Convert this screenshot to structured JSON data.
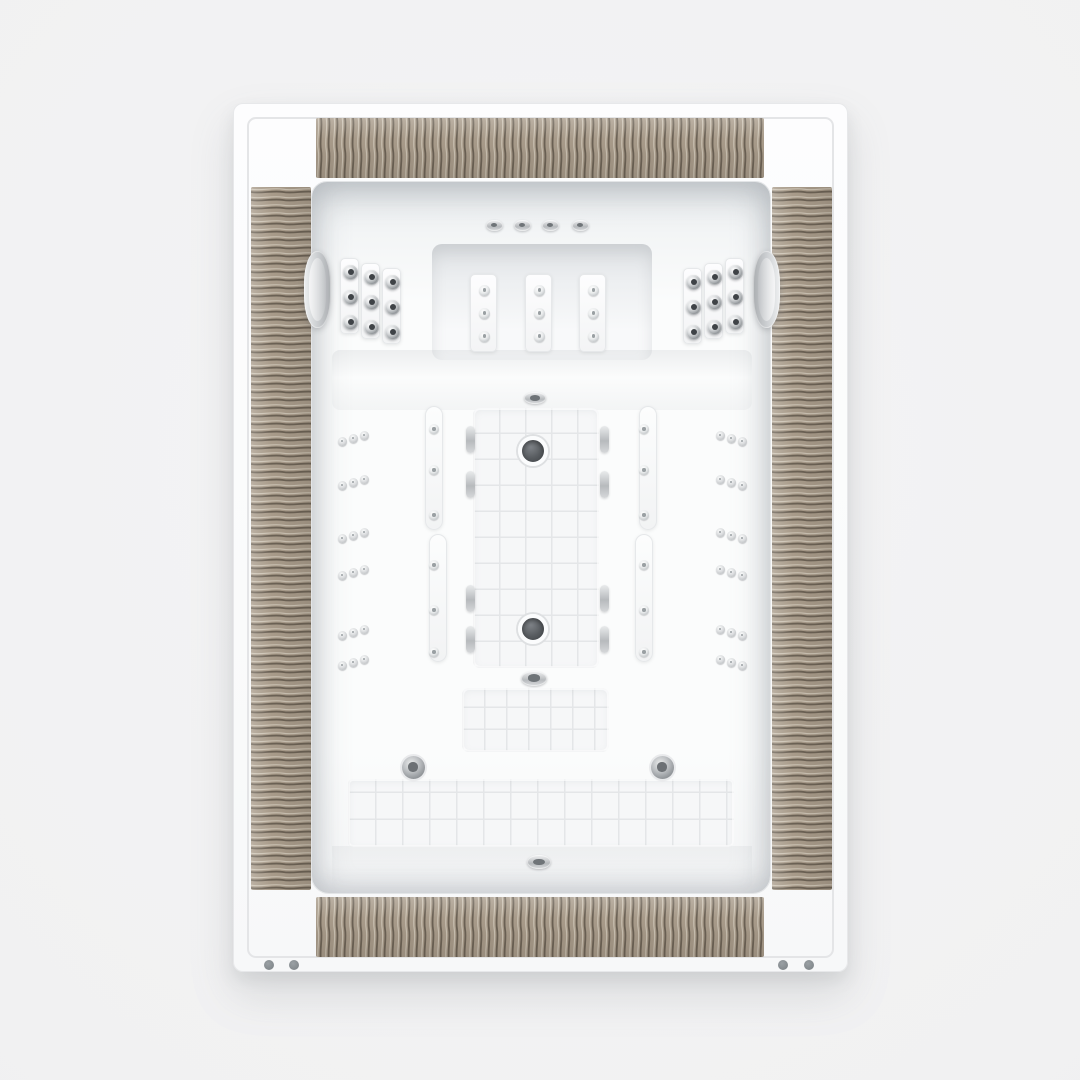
{
  "scene": {
    "title": "Whirlpool bathtub - top view",
    "description": "Top-down product photo of a white rectangular drop-in whirlpool bathtub with taupe carved-wave wood deck inlays, two gray headrests, shoulder and wall massage jets, textured non-slip floor, seat bench and twin dark drains",
    "background": "#f1f1f2"
  },
  "colors": {
    "background": "#f1f1f2",
    "shell_white": "#fbfbfc",
    "outline": "#e4e5e7",
    "wood_base": "#a89b8a",
    "wood_groove": "#6b6154",
    "wood_highlight": "#d3cabb",
    "basin_shadow": "#d9dcdf",
    "metal_light": "#eff0f1",
    "metal_mid": "#b6b9bd",
    "metal_slot": "#6f7478",
    "metal_slot_light": "#9aa0a3",
    "metal_dark_center": "#3f4347",
    "drain_dark": "#54585b",
    "headrest_gray": "#c8cbce",
    "texture_line": "#e4e6e8",
    "foot_dot": "#85898d"
  },
  "counts": {
    "headrests": 2,
    "back_ledge_jets": 4,
    "back_wall_jets": 9,
    "shoulder_jets_per_side": 9,
    "wall_jets_per_side": 18,
    "rail_jets_per_side": 6,
    "floor_drains": 2,
    "bench_jets": 2,
    "deck_fittings": 3,
    "mounting_dots": 4,
    "wood_panels": 4
  },
  "fixtures": {
    "tub": {
      "x": 233,
      "y": 103,
      "w": 615,
      "h": 869
    },
    "outline_inset": 13,
    "wood_panels": [
      {
        "name": "deck-panel-top",
        "x": 82,
        "y": 14,
        "w": 448,
        "h": 60,
        "grain": "vertical"
      },
      {
        "name": "deck-panel-bottom",
        "x": 82,
        "y": 793,
        "w": 448,
        "h": 60,
        "grain": "vertical"
      },
      {
        "name": "deck-panel-left",
        "x": 17,
        "y": 83,
        "w": 60,
        "h": 703,
        "grain": "horizontal"
      },
      {
        "name": "deck-panel-right",
        "x": 538,
        "y": 83,
        "w": 60,
        "h": 703,
        "grain": "horizontal"
      }
    ],
    "basin": {
      "x": 77,
      "y": 77,
      "w": 460,
      "h": 713
    },
    "back_recess": {
      "x": 120,
      "y": 62,
      "w": 220,
      "h": 116
    },
    "ledge_jets": {
      "cy": 43,
      "cxs": [
        182,
        210,
        238,
        268
      ],
      "w": 17,
      "h": 11
    },
    "back_strips": {
      "lefts": [
        158,
        213,
        267
      ],
      "top": 92,
      "w": 27,
      "h": 78,
      "jet_cys": [
        15,
        38,
        61
      ],
      "jet_size": 11
    },
    "shoulder_panels": [
      {
        "name": "shoulder-panel-left",
        "x": 28,
        "y": 76,
        "staggers": [
          0,
          5,
          10
        ]
      },
      {
        "name": "shoulder-panel-right",
        "x": 371,
        "y": 76,
        "staggers": [
          10,
          5,
          0
        ]
      }
    ],
    "shoulder_strip": {
      "w": 19,
      "h": 76,
      "gap": 2,
      "jet_cys": [
        13,
        38,
        63
      ],
      "jet_size": 15
    },
    "headrests": [
      {
        "name": "headrest-left",
        "x": -8,
        "y": 69,
        "flip": false
      },
      {
        "name": "headrest-right",
        "x": 441,
        "y": 69,
        "flip": true
      }
    ],
    "headrest_size": {
      "w": 27,
      "h": 77
    },
    "rails": [
      {
        "name": "rail-left-upper",
        "x": 113,
        "y": 224,
        "w": 18,
        "h": 124
      },
      {
        "name": "rail-left-lower",
        "x": 117,
        "y": 352,
        "w": 18,
        "h": 128
      },
      {
        "name": "rail-right-upper",
        "x": 327,
        "y": 224,
        "w": 18,
        "h": 124
      },
      {
        "name": "rail-right-lower",
        "x": 323,
        "y": 352,
        "w": 18,
        "h": 128
      }
    ],
    "rail_jets": {
      "left_cx": 122,
      "right_cx": 332,
      "cys": [
        247,
        288,
        333,
        383,
        428,
        470
      ],
      "size": 10
    },
    "wall_triads": {
      "left_cx": 41,
      "right_cx": 419,
      "cys": [
        256,
        300,
        353,
        390,
        450,
        480
      ],
      "jet_size": 9,
      "dx": 11,
      "dy": 3
    },
    "floor": {
      "x": 161,
      "y": 226,
      "w": 126,
      "h": 260,
      "grid": 26
    },
    "drains": [
      {
        "cx": 60,
        "cy": 43
      },
      {
        "cx": 60,
        "cy": 221
      }
    ],
    "drain_size": 30,
    "floor_pills": {
      "left_cx": 158,
      "right_cx": 292,
      "cys": [
        257,
        302,
        416,
        457
      ],
      "w": 9,
      "h": 27
    },
    "fittings": [
      {
        "name": "deck-fitting",
        "cx": 223,
        "cy": 216,
        "w": 22,
        "h": 12
      },
      {
        "name": "mid-fitting",
        "cx": 222,
        "cy": 496,
        "w": 26,
        "h": 15
      },
      {
        "name": "front-fitting",
        "cx": 227,
        "cy": 680,
        "w": 24,
        "h": 14
      }
    ],
    "footwell": {
      "x": 150,
      "y": 506,
      "w": 147,
      "h": 64,
      "grid": 22
    },
    "bench": {
      "x": 36,
      "y": 597,
      "w": 386,
      "h": 68,
      "grid": 27
    },
    "bench_jets": {
      "size": 23,
      "points": [
        {
          "cx": 101,
          "cy": 585
        },
        {
          "cx": 350,
          "cy": 585
        }
      ]
    },
    "feet_dots": {
      "size": 10,
      "points": [
        {
          "cx": 35,
          "cy": 861
        },
        {
          "cx": 60,
          "cy": 861
        },
        {
          "cx": 549,
          "cy": 861
        },
        {
          "cx": 575,
          "cy": 861
        }
      ]
    }
  }
}
